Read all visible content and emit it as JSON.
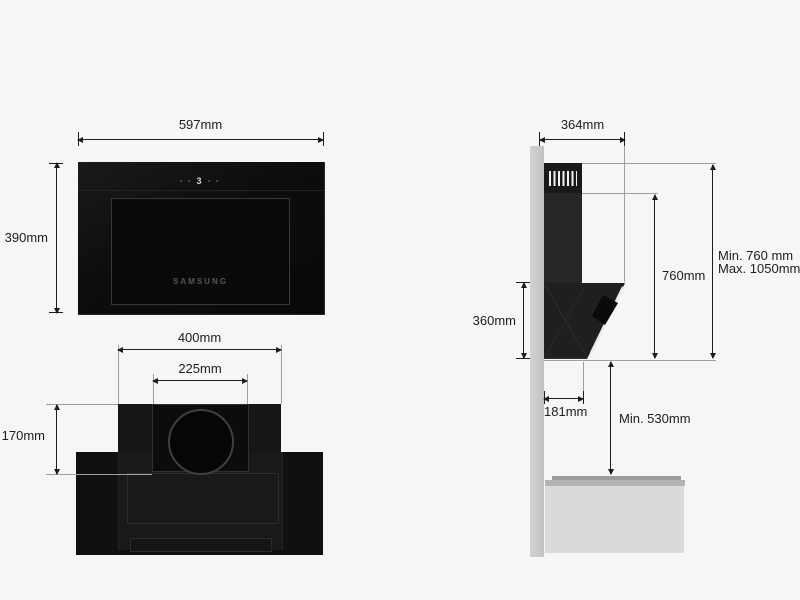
{
  "front_view": {
    "width_label": "597mm",
    "height_label": "390mm",
    "brand": "SAMSUNG",
    "display_level": "3"
  },
  "bottom_view": {
    "width_label": "400mm",
    "duct_width_label": "225mm",
    "depth_label": "170mm"
  },
  "side_view": {
    "depth_label": "364mm",
    "front_height_label": "360mm",
    "hood_height_label": "760mm",
    "height_range_min_label": "Min. 760 mm",
    "height_range_max_label": "Max. 1050mm",
    "bottom_depth_label": "181mm",
    "cooktop_clearance_label": "Min. 530mm"
  },
  "colors": {
    "background": "#f6f6f6",
    "hood_black": "#101010",
    "wall_gray": "#c8c8c8",
    "cabinet_gray": "#dadada",
    "dimension_line": "#1d1d1d",
    "extension_line": "#9f9f9f",
    "brand_text": "#565656"
  }
}
